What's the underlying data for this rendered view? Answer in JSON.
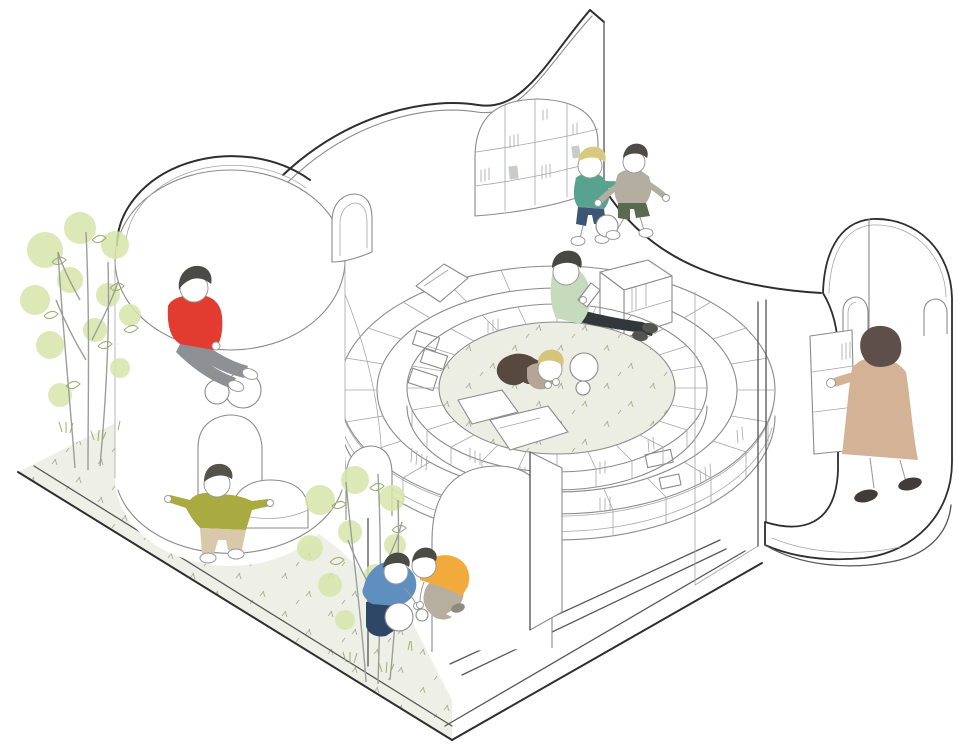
{
  "meta": {
    "kind": "architectural-axonometric-illustration",
    "subject": "Spiral children's library pavilion cutaway with reading pit, curved bookshelf walls, arched rooms, trees and playing children",
    "canvas": {
      "width": 960,
      "height": 752
    }
  },
  "palette": {
    "white": "#ffffff",
    "line_dark": "#2e2e2e",
    "line_mid": "#8b8b8b",
    "line_soft": "#a6a6a6",
    "pit_floor": "#ecede3",
    "ground": "#eef0e8",
    "speckle": "#a9b49a",
    "leaf_wash": "#d7e6ab",
    "leaf_line": "#9cad72",
    "trunk": "#9d9d99",
    "book_gray": "#c9cdc9"
  },
  "scene": {
    "structures": [
      {
        "id": "fin-wall",
        "label": "tall S-curved fin wall with arched inset bookshelf"
      },
      {
        "id": "outer-ring",
        "label": "outer curved bookshelf ring"
      },
      {
        "id": "inner-ring",
        "label": "inner curved bookshelf ring around sunken reading pit"
      },
      {
        "id": "reading-pit",
        "label": "sunken circular reading pit with pillows and balls"
      },
      {
        "id": "left-drum",
        "label": "cylindrical room with arched door and wall circles"
      },
      {
        "id": "alcove",
        "label": "arched alcove where two children play ball"
      },
      {
        "id": "booth",
        "label": "rounded service booth with arched windows and counter"
      },
      {
        "id": "slab",
        "label": "cut base slab with outdoor planted strip"
      }
    ],
    "figures": [
      {
        "id": "boy-red-sitting",
        "label": "boy in red shirt sitting on drum rim",
        "colors": {
          "hair": "#4a4a46",
          "shirt": "#e23b30",
          "pants": "#8f9094",
          "shoes": "#ffffff"
        }
      },
      {
        "id": "boy-olive-walking",
        "label": "boy in olive shirt walking outdoors",
        "colors": {
          "hair": "#55524c",
          "shirt": "#a9aa3f",
          "pants": "#d8c9ab",
          "shoes": "#ffffff"
        }
      },
      {
        "id": "boy-blue-crouching",
        "label": "boy in blue sweater crouching with big ball",
        "colors": {
          "hair": "#4a4a46",
          "shirt": "#5f8fbf",
          "pants": "#2f4766",
          "shoes": "#ffffff"
        }
      },
      {
        "id": "boy-orange-crouching",
        "label": "boy in orange shirt crouching with small ball",
        "colors": {
          "hair": "#4a4a46",
          "shirt": "#f3aa3c",
          "pants": "#b6afa0",
          "shoes": "#8f8a80"
        }
      },
      {
        "id": "reader-sage",
        "label": "person in sage top reading on shelf",
        "colors": {
          "hair": "#474743",
          "shirt": "#c6dabc",
          "pants": "#31373a",
          "shoes": "#55554f",
          "book": "#ffffff"
        }
      },
      {
        "id": "child-lying",
        "label": "blond child lying in reading pit",
        "colors": {
          "hair": "#d5c47c",
          "shirt": "#b4a597",
          "pants": "#57493f"
        }
      },
      {
        "id": "boy-teal-ball",
        "label": "blond boy in teal shirt playing football",
        "colors": {
          "hair": "#d9c97e",
          "shirt": "#58a290",
          "pants": "#3c5673",
          "shoes": "#ffffff"
        }
      },
      {
        "id": "boy-gray-ball",
        "label": "boy in gray shirt and green shorts playing",
        "colors": {
          "hair": "#4f4c47",
          "shirt": "#b3ae9f",
          "pants": "#5a6a4f",
          "shoes": "#ffffff"
        }
      },
      {
        "id": "woman-standing",
        "label": "woman in tan coat at booth counter",
        "colors": {
          "hair": "#5e4f4b",
          "coat": "#d4b296",
          "shoes": "#413c39"
        }
      }
    ],
    "objects": [
      {
        "id": "pillows",
        "label": "white floor pillows",
        "count": 3
      },
      {
        "id": "balls",
        "label": "white play balls",
        "count": 4
      },
      {
        "id": "books",
        "label": "books on curved shelves"
      }
    ],
    "vegetation": [
      {
        "id": "tree-left",
        "label": "young trees on outdoor strip (left)"
      },
      {
        "id": "tree-front",
        "label": "young tree in front of alcove wall"
      }
    ]
  }
}
